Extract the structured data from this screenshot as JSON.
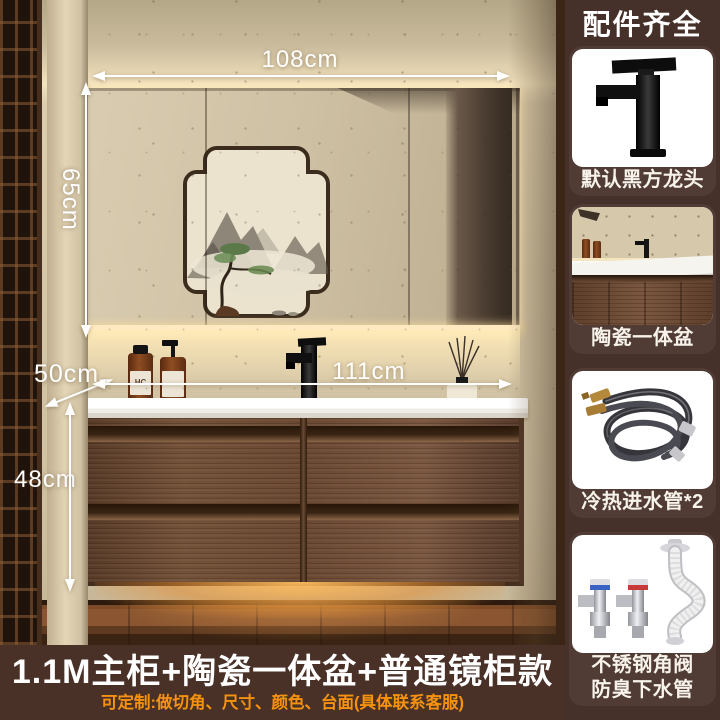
{
  "scene": {
    "dimensions": {
      "mirror_width": "108cm",
      "mirror_height": "65cm",
      "counter_depth": "50cm",
      "basin_width": "111cm",
      "cabinet_height": "48cm"
    },
    "bottle_label": "HC",
    "description_icons": {
      "mirror": "led-mirror-cabinet",
      "painting": "chinese-landscape-painting-reflection",
      "cabinet": "walnut-four-drawer-vanity",
      "basin": "white-ceramic-countertop-basin",
      "faucet": "black-square-faucet"
    }
  },
  "banner": {
    "title": "1.1M主柜+陶瓷一体盆+普通镜柜款",
    "subtitle": "可定制:做切角、尺寸、颜色、台面(具体联系客服)"
  },
  "sidebar": {
    "title": "配件齐全",
    "cards": [
      {
        "label": "默认黑方龙头",
        "icon": "black-square-faucet-image"
      },
      {
        "label": "陶瓷一体盆",
        "icon": "ceramic-basin-photo"
      },
      {
        "label": "冷热进水管*2",
        "icon": "braided-inlet-hoses-image"
      },
      {
        "label_line1": "不锈钢角阀",
        "label_line2": "防臭下水管",
        "icon": "angle-valves-and-drain-image"
      }
    ]
  },
  "colors": {
    "sidebar_bg": "#46302a",
    "banner_bg": "#4a3128",
    "banner_title": "#ffffff",
    "banner_subtitle": "#f6920f",
    "dimension_text": "#ffffff",
    "cabinet_wood": "#6e4b33",
    "wall_beige": "#d5c7a8",
    "counter_white": "#f7f5f0",
    "glow_amber": "#e8a24a",
    "valve_blue": "#3a62c4",
    "valve_red": "#c83a3a"
  }
}
